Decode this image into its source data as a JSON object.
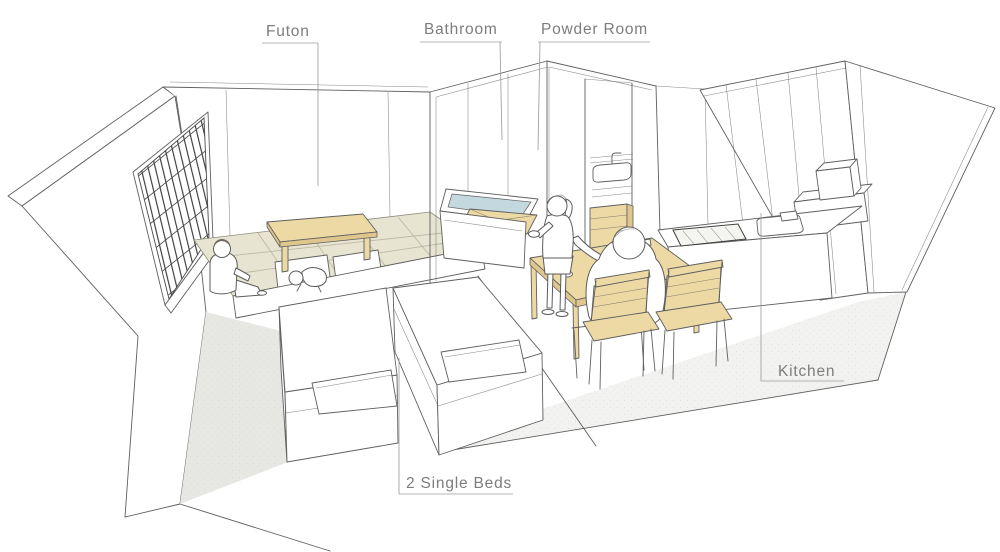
{
  "illustration": {
    "labels": {
      "futon": "Futon",
      "bathroom": "Bathroom",
      "powder_room": "Powder Room",
      "kitchen": "Kitchen",
      "beds": "2 Single Beds"
    },
    "colors": {
      "line": "#5f5f5f",
      "label_text": "#7d7d7d",
      "wood": "#ecd9a4",
      "wood_dark": "#dfc68c",
      "tatami": "#e7e4d1",
      "tatami_line": "#bdbaa4",
      "water": "#c3d9df",
      "floor_shadow": "#e7e7e4",
      "hair": "#6e675e"
    }
  }
}
